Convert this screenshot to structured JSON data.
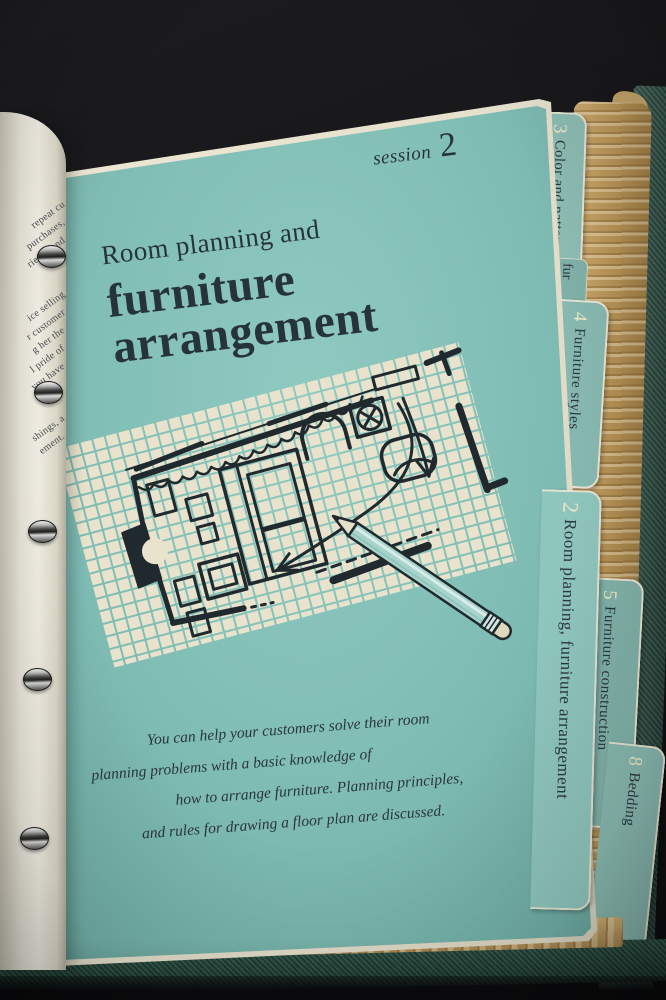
{
  "page": {
    "session_label": "session",
    "session_number": "2",
    "title": [
      "Room planning and",
      "furniture",
      "arrangement"
    ],
    "intro": [
      "You can help your customers solve their room",
      "planning problems with a basic knowledge of",
      "how to arrange furniture. Planning principles,",
      "and rules for drawing a floor plan are discussed."
    ]
  },
  "tabs": {
    "color_pattern": {
      "number": "3",
      "label": "Color and pattern"
    },
    "hidden_fragment": {
      "label": "fur"
    },
    "furniture_styles": {
      "number": "4",
      "label": "Furniture styles"
    },
    "room_planning": {
      "number": "2",
      "label": "Room planning, furniture arrangement"
    },
    "furniture_construction": {
      "number": "5",
      "label": "Furniture construction"
    },
    "bedding": {
      "number": "8",
      "label": "Bedding"
    }
  },
  "left_page_fragments": [
    "repeat cu",
    "purchases,",
    "riends and",
    "ice selling",
    "r customer",
    "g her the",
    "l pride of",
    "you have",
    "shings, a",
    "ement."
  ],
  "colors": {
    "page_teal": "#81beb6",
    "ink": "#27333c",
    "grid_paper": "#e9e3cd",
    "tab_teal": "#8cbcb3",
    "tan_pages": "#b79356",
    "cover_green": "#3a5a4f",
    "pencil_body": "#a6d4cc",
    "number_cream": "#ece6c6"
  }
}
